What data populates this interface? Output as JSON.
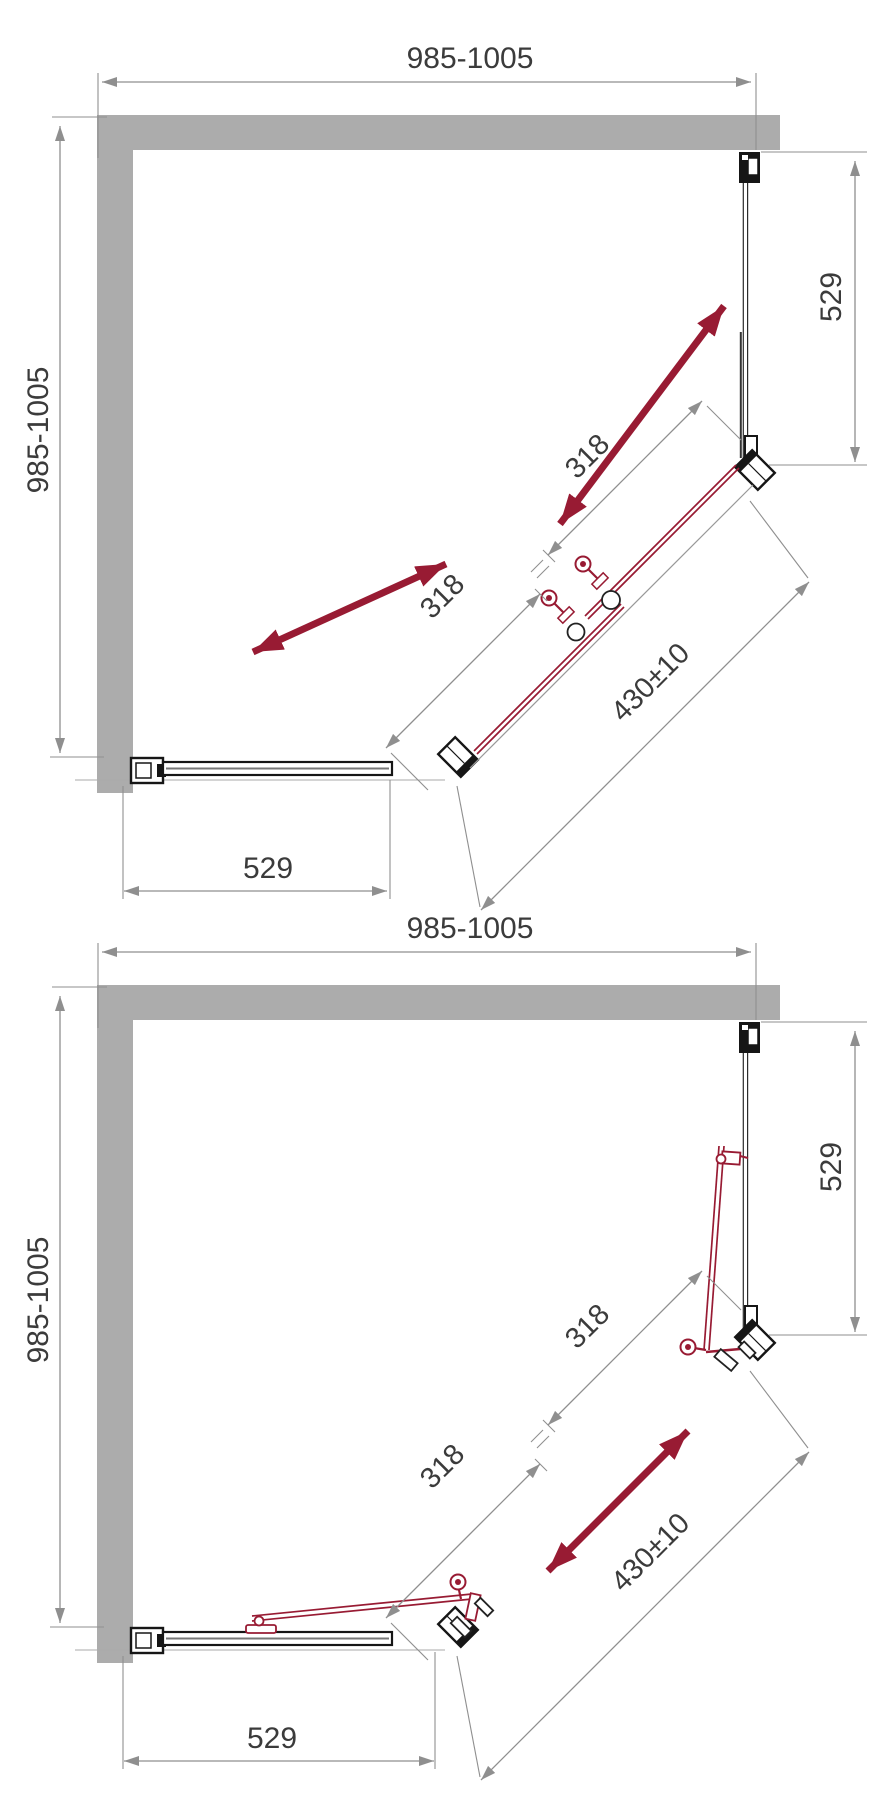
{
  "drawing": {
    "colors": {
      "wall_gray": "#ACACAC",
      "dimension_gray": "#8F8F8F",
      "profile_outline": "#1C1C1C",
      "accent_red": "#981B33",
      "text": "#3B3B3B",
      "background": "#FFFFFF"
    },
    "diagrams": [
      {
        "id": "doors-closed",
        "labels": {
          "width_top": "985-1005",
          "depth_left": "985-1005",
          "panel_right": "529",
          "panel_bottom": "529",
          "door_upper": "318",
          "door_lower": "318",
          "diagonal_opening": "430±10"
        }
      },
      {
        "id": "doors-open",
        "labels": {
          "width_top": "985-1005",
          "depth_left": "985-1005",
          "panel_right": "529",
          "panel_bottom": "529",
          "door_upper": "318",
          "door_lower": "318",
          "diagonal_opening": "430±10"
        }
      }
    ]
  }
}
